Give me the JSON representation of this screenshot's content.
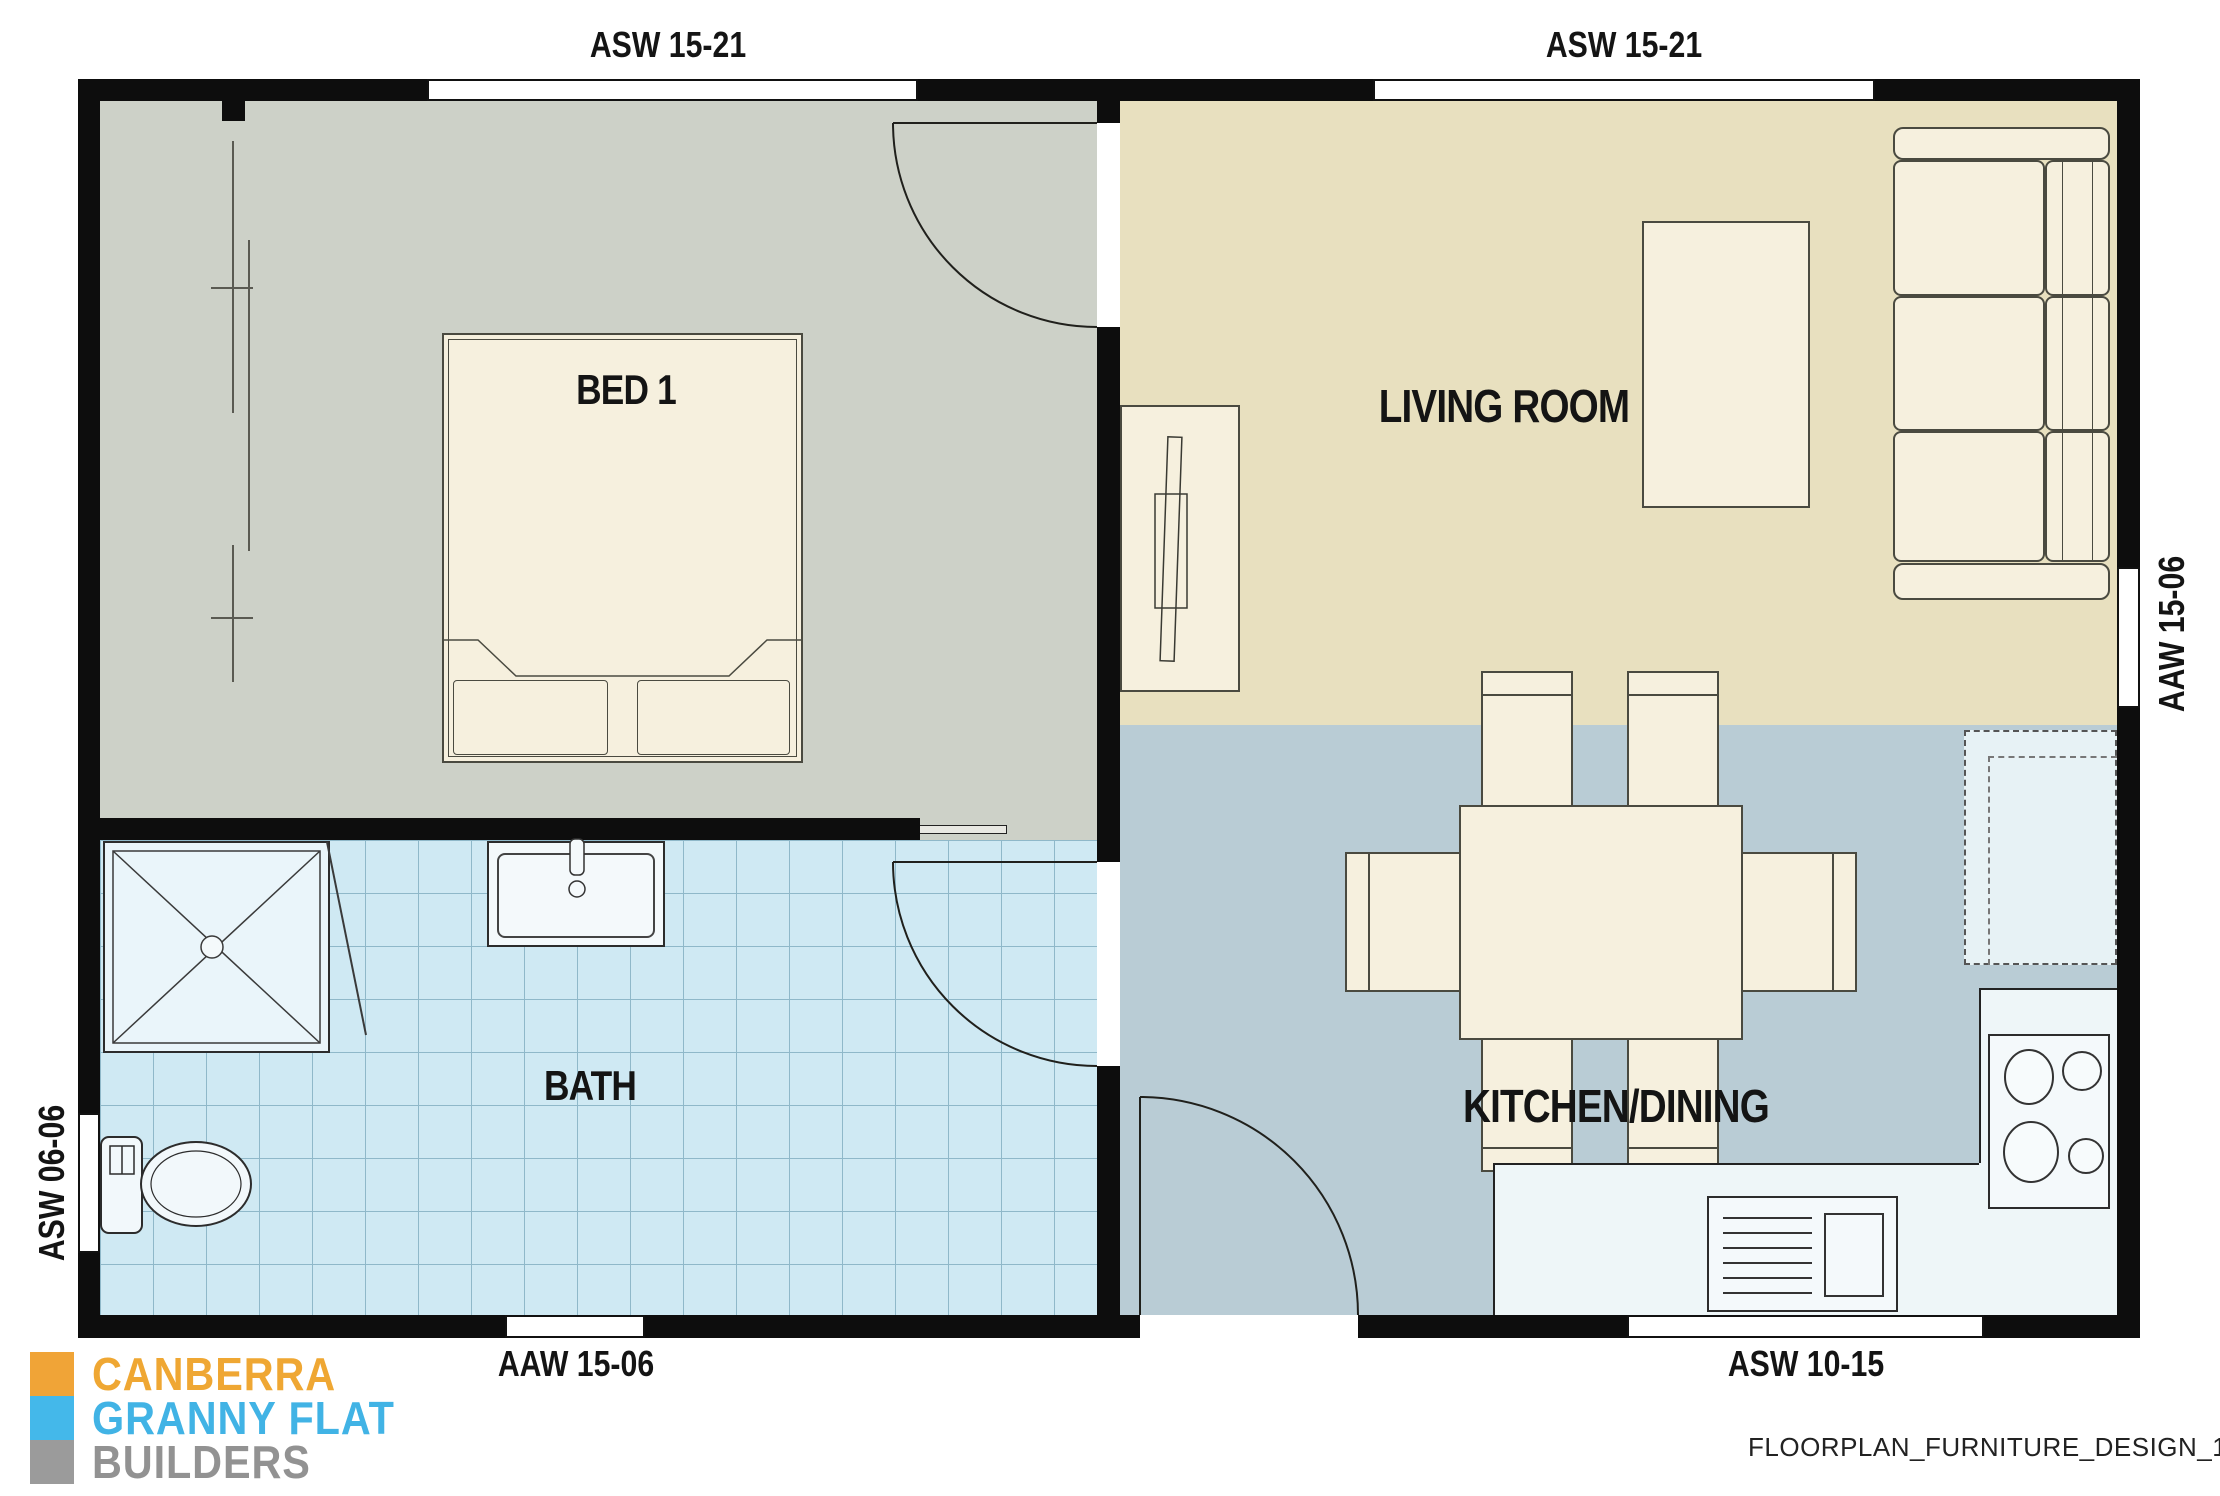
{
  "title": "Granny flat floor plan with furniture",
  "rooms": {
    "bed": "BED 1",
    "living": "LIVING ROOM",
    "bath": "BATH",
    "kitchen": "KITCHEN/DINING"
  },
  "windows": {
    "top_left": "ASW 15-21",
    "top_right": "ASW 15-21",
    "right": "AAW 15-06",
    "left": "ASW 06-06",
    "bottom_left": "AAW 15-06",
    "bottom_right": "ASW 10-15"
  },
  "logo": {
    "line1": "CANBERRA",
    "line2": "GRANNY FLAT",
    "line3": "BUILDERS",
    "color1": "#efa733",
    "color2": "#41b3e5",
    "color3": "#929292"
  },
  "footer": {
    "drawing_id": "FLOORPLAN_FURNITURE_DESIGN_102"
  },
  "colors": {
    "wall": "#0d0d0d",
    "bedroom_floor": "#cdd1c8",
    "living_floor": "#e8e0bf",
    "kitchen_floor": "#b9ccd5",
    "bath_floor": "#cfe9f3",
    "bath_tile_line": "#8fb8c9",
    "furniture_cream": "#f6f0de",
    "counter": "#eef6f8"
  }
}
